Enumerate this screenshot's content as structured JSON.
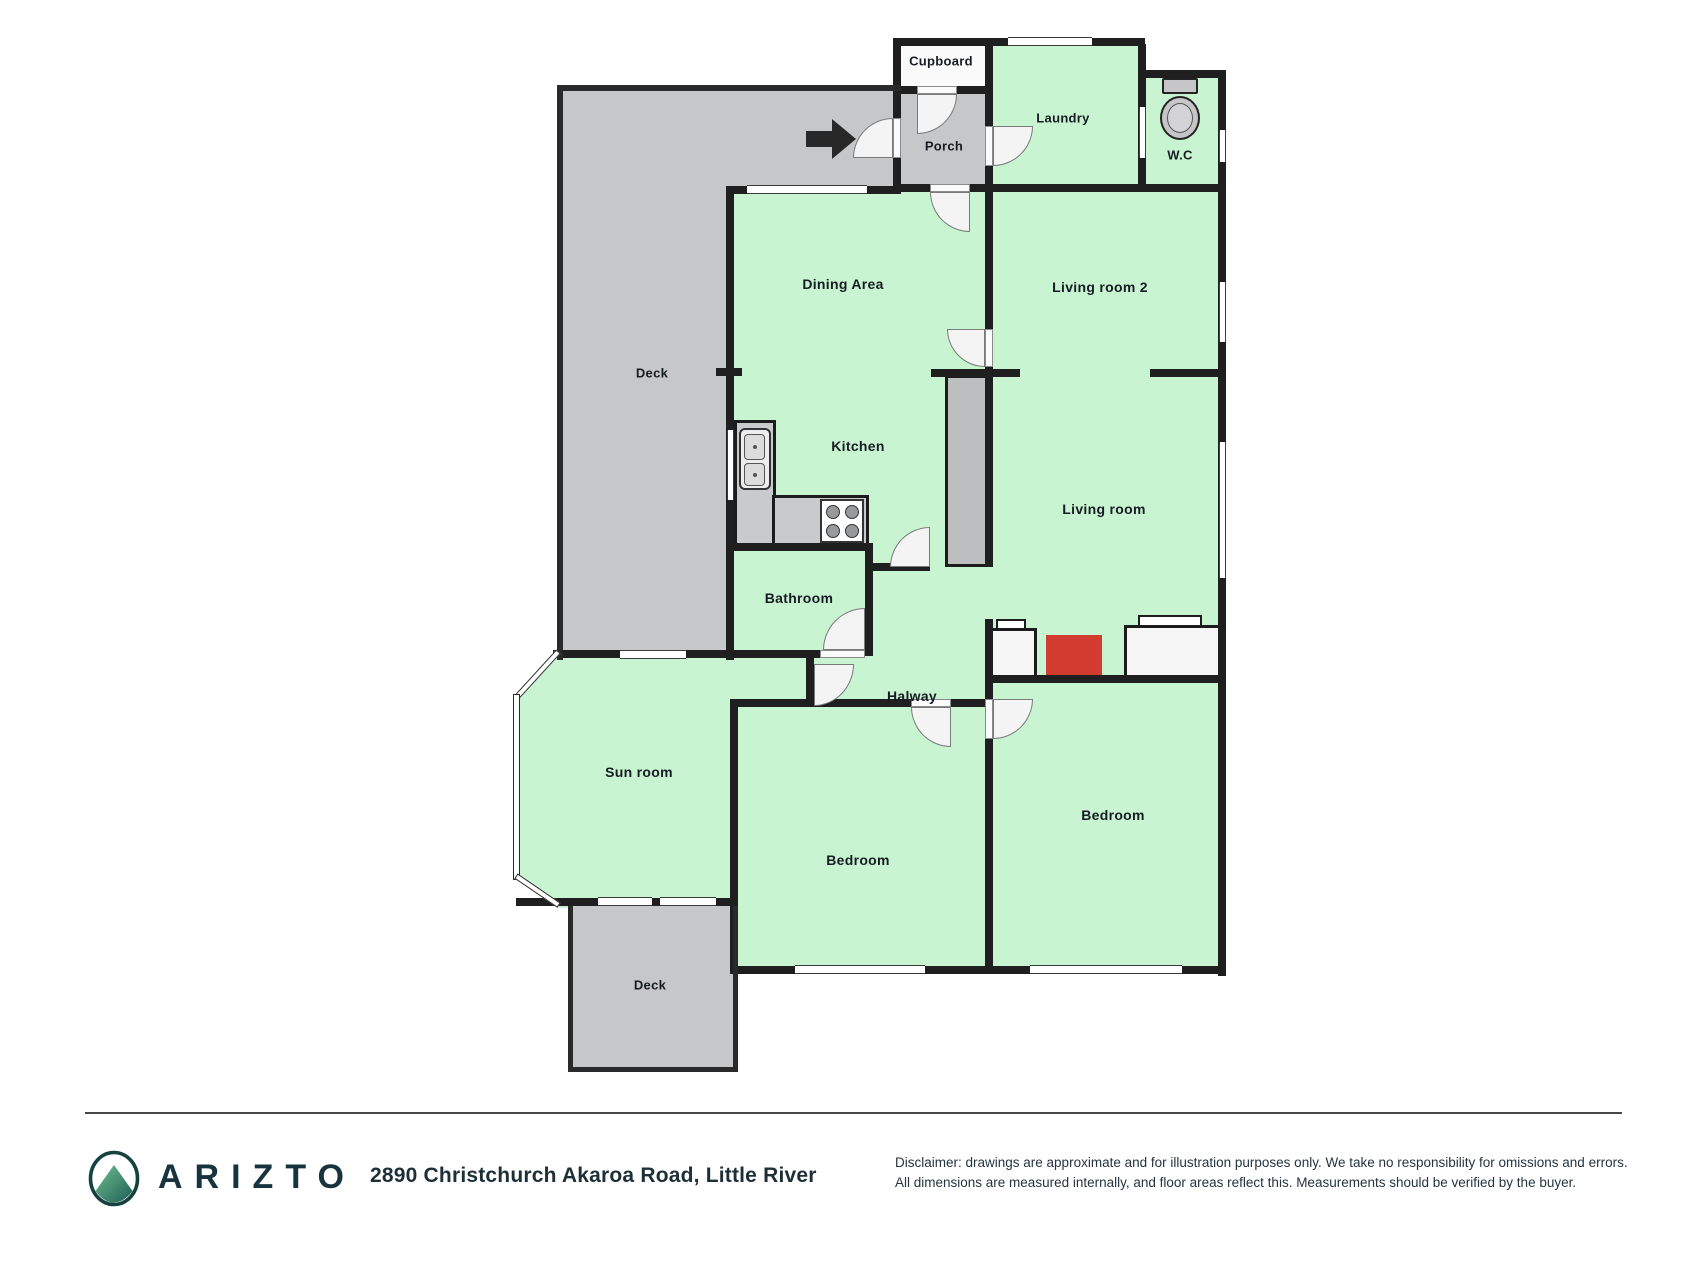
{
  "floorplan": {
    "rooms": {
      "cupboard": {
        "label": "Cupboard"
      },
      "porch": {
        "label": "Porch"
      },
      "laundry": {
        "label": "Laundry"
      },
      "wc": {
        "label": "W.C"
      },
      "deck_top": {
        "label": "Deck"
      },
      "dining": {
        "label": "Dining Area"
      },
      "living_room_2": {
        "label": "Living room 2"
      },
      "kitchen": {
        "label": "Kitchen"
      },
      "living_room": {
        "label": "Living room"
      },
      "bathroom": {
        "label": "Bathroom"
      },
      "halway": {
        "label": "Halway"
      },
      "sun_room": {
        "label": "Sun room"
      },
      "bedroom_middle": {
        "label": "Bedroom"
      },
      "bedroom_right": {
        "label": "Bedroom"
      },
      "deck_bottom": {
        "label": "Deck"
      }
    },
    "icons": {
      "entrance_arrow": "black right-pointing entrance arrow",
      "toilet": "toilet plan icon",
      "sink": "double kitchen sink",
      "stove": "four-burner stove",
      "fireplace": "fireplace"
    },
    "colors": {
      "room_fill": "#c9f4d1",
      "deck_fill": "#c6c7c8",
      "wall": "#1f1f1f",
      "fireplace": "#d23b30",
      "chimney": "#bcbec0",
      "door": "#f4f4f4"
    }
  },
  "footer": {
    "brand": "ARIZTO",
    "brand_color": "#17333d",
    "address": "2890 Christchurch Akaroa Road, Little River",
    "disclaimer_line1": "Disclaimer: drawings are approximate and for illustration purposes only. We take no responsibility for omissions and errors.",
    "disclaimer_line2": "All dimensions are measured internally, and floor areas reflect this. Measurements should be verified by the buyer."
  }
}
